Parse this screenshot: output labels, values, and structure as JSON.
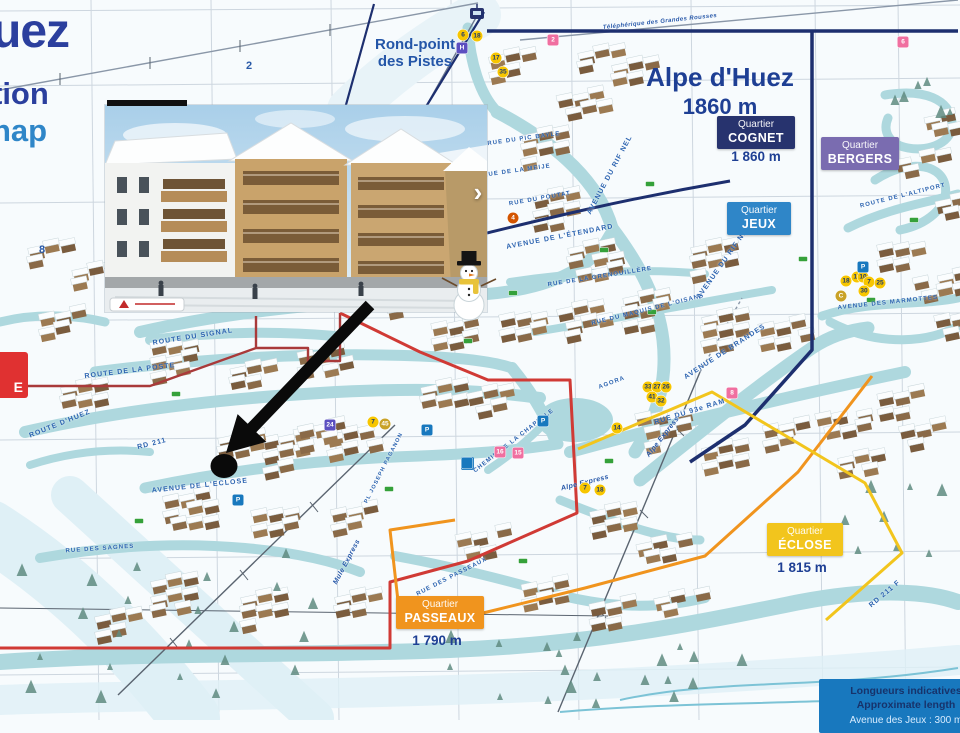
{
  "logo": {
    "line1": "uez",
    "line2": "tion",
    "line3": "nap"
  },
  "rondpoint": {
    "line1": "Rond-point",
    "line2": "des Pistes"
  },
  "title": {
    "name": "Alpe d'Huez",
    "elevation": "1860 m"
  },
  "quartiers": {
    "cognet": {
      "label": "Quartier",
      "name": "COGNET",
      "elevation": "1 860 m"
    },
    "bergers": {
      "label": "Quartier",
      "name": "BERGERS"
    },
    "jeux": {
      "label": "Quartier",
      "name": "JEUX"
    },
    "eclose": {
      "label": "Quartier",
      "name": "ÉCLOSE",
      "elevation": "1 815 m"
    },
    "passeaux": {
      "label": "Quartier",
      "name": "PASSEAUX",
      "elevation": "1 790 m"
    }
  },
  "legend": {
    "line1": "Longueurs indicatives",
    "line2": "Approximate length",
    "line3": "Avenue des Jeux : 300 m"
  },
  "edge_sign": {
    "visible_text": "E"
  },
  "grid_labels": [
    {
      "t": "2",
      "x": 246,
      "y": 60
    },
    {
      "t": "8",
      "x": 39,
      "y": 244
    }
  ],
  "streets": [
    {
      "label": "ROUTE DU SIGNAL",
      "x": 193,
      "y": 337,
      "r": -9
    },
    {
      "label": "ROUTE DE LA POSTE",
      "x": 130,
      "y": 371,
      "r": -7
    },
    {
      "label": "ROUTE  D'HUEZ",
      "x": 60,
      "y": 424,
      "r": -22
    },
    {
      "label": "RD 211",
      "x": 152,
      "y": 444,
      "r": -14
    },
    {
      "label": "AVENUE DE L'ECLOSE",
      "x": 200,
      "y": 486,
      "r": -6
    },
    {
      "label": "RUE DES SAGNES",
      "x": 100,
      "y": 549,
      "r": -4,
      "fs": 6
    },
    {
      "label": "RUE DES PASSEAUX",
      "x": 452,
      "y": 577,
      "r": -27,
      "fs": 6
    },
    {
      "label": "PL JOSEPH PAGANON",
      "x": 384,
      "y": 468,
      "r": -63,
      "fs": 5.5
    },
    {
      "label": "CHEMIN DE LA CHAPELLE",
      "x": 514,
      "y": 441,
      "r": -38,
      "fs": 6
    },
    {
      "label": "RUE DU 93e RAM",
      "x": 690,
      "y": 412,
      "r": -17
    },
    {
      "label": "AVENUE DE BRANDES",
      "x": 725,
      "y": 352,
      "r": -33
    },
    {
      "label": "AVENUE DES MARMOTTES",
      "x": 888,
      "y": 303,
      "r": -6,
      "fs": 6
    },
    {
      "label": "ROUTE DE L'ALTIPORT",
      "x": 903,
      "y": 196,
      "r": -14,
      "fs": 6
    },
    {
      "label": "AVENUE DE L'ÉTENDARD",
      "x": 560,
      "y": 237,
      "r": -11
    },
    {
      "label": "RUE DE LA GRENOUILLÈRE",
      "x": 600,
      "y": 277,
      "r": -9,
      "fs": 6
    },
    {
      "label": "RUE DU MAQUIS DE L'OISANS",
      "x": 648,
      "y": 310,
      "r": -14,
      "fs": 6
    },
    {
      "label": "AVENUE DU RIF NEL",
      "x": 610,
      "y": 175,
      "r": -62
    },
    {
      "label": "AVENUE DU RIF NEL",
      "x": 724,
      "y": 262,
      "r": -55
    },
    {
      "label": "RUE DE LA MEIJE",
      "x": 517,
      "y": 171,
      "r": -8,
      "fs": 6
    },
    {
      "label": "RUE DU POUTAT",
      "x": 540,
      "y": 199,
      "r": -10,
      "fs": 6
    },
    {
      "label": "RUE DU PIC BAYLE",
      "x": 524,
      "y": 139,
      "r": -8,
      "fs": 6
    },
    {
      "label": "RD 211 F",
      "x": 885,
      "y": 594,
      "r": -40
    },
    {
      "label": "AGORA",
      "x": 612,
      "y": 383,
      "r": -20,
      "fs": 6
    }
  ],
  "lifts": [
    {
      "label": "Téléphérique des Grandes Rousses",
      "x": 660,
      "y": 22,
      "r": -6,
      "fs": 6
    },
    {
      "label": "Alpe Express",
      "x": 585,
      "y": 483,
      "r": -14
    },
    {
      "label": "Alpe Express",
      "x": 663,
      "y": 437,
      "r": -52
    },
    {
      "label": "Mule Express",
      "x": 347,
      "y": 562,
      "r": -62
    }
  ],
  "badges": [
    {
      "x": 463,
      "y": 35,
      "c": "y",
      "t": "6"
    },
    {
      "x": 477,
      "y": 36,
      "c": "y",
      "t": "18"
    },
    {
      "x": 496,
      "y": 58,
      "c": "y",
      "t": "17"
    },
    {
      "x": 503,
      "y": 72,
      "c": "y",
      "t": "35"
    },
    {
      "x": 553,
      "y": 40,
      "c": "p",
      "t": "2"
    },
    {
      "x": 903,
      "y": 42,
      "c": "p",
      "t": "6"
    },
    {
      "x": 513,
      "y": 218,
      "c": "o",
      "t": "4"
    },
    {
      "x": 648,
      "y": 387,
      "c": "y",
      "t": "33"
    },
    {
      "x": 657,
      "y": 387,
      "c": "y",
      "t": "27"
    },
    {
      "x": 666,
      "y": 387,
      "c": "y",
      "t": "26"
    },
    {
      "x": 652,
      "y": 397,
      "c": "y",
      "t": "41"
    },
    {
      "x": 661,
      "y": 401,
      "c": "y",
      "t": "32"
    },
    {
      "x": 617,
      "y": 428,
      "c": "y",
      "t": "14"
    },
    {
      "x": 846,
      "y": 281,
      "c": "y",
      "t": "18"
    },
    {
      "x": 857,
      "y": 277,
      "c": "y",
      "t": "17"
    },
    {
      "x": 863,
      "y": 277,
      "c": "y",
      "t": "10"
    },
    {
      "x": 869,
      "y": 282,
      "c": "y",
      "t": "7"
    },
    {
      "x": 880,
      "y": 283,
      "c": "y",
      "t": "25"
    },
    {
      "x": 864,
      "y": 291,
      "c": "y",
      "t": "30"
    },
    {
      "x": 841,
      "y": 296,
      "c": "gold",
      "t": "C"
    },
    {
      "x": 373,
      "y": 422,
      "c": "y",
      "t": "7"
    },
    {
      "x": 385,
      "y": 424,
      "c": "gold",
      "t": "45"
    },
    {
      "x": 500,
      "y": 452,
      "c": "p",
      "t": "16"
    },
    {
      "x": 518,
      "y": 453,
      "c": "p",
      "t": "15"
    },
    {
      "x": 732,
      "y": 393,
      "c": "p",
      "t": "8"
    },
    {
      "x": 585,
      "y": 488,
      "c": "y",
      "t": "7"
    },
    {
      "x": 600,
      "y": 490,
      "c": "y",
      "t": "18"
    },
    {
      "x": 543,
      "y": 421,
      "c": "b",
      "t": "P"
    },
    {
      "x": 863,
      "y": 267,
      "c": "b",
      "t": "P"
    },
    {
      "x": 427,
      "y": 430,
      "c": "b",
      "t": "P"
    },
    {
      "x": 238,
      "y": 500,
      "c": "b",
      "t": "P"
    },
    {
      "x": 330,
      "y": 425,
      "c": "v",
      "t": "24"
    },
    {
      "x": 462,
      "y": 48,
      "c": "v",
      "t": "H"
    },
    {
      "x": 467,
      "y": 463,
      "c": "b",
      "t": ""
    }
  ],
  "colors": {
    "cognet": "#27336e",
    "bergers": "#7a6cb0",
    "jeux": "#2f86c8",
    "eclose": "#f2c51d",
    "passeaux": "#f0941e",
    "legend_bg": "#1878be",
    "road": "#aed8de",
    "navy_boundary": "#1d2f6f",
    "red_boundary": "#d03a35",
    "orange_boundary": "#f0941e",
    "yellow_boundary": "#f2c51d",
    "title_text": "#1e3f94",
    "street_text": "#2b63b0",
    "arrow": "#0a0a0a"
  }
}
